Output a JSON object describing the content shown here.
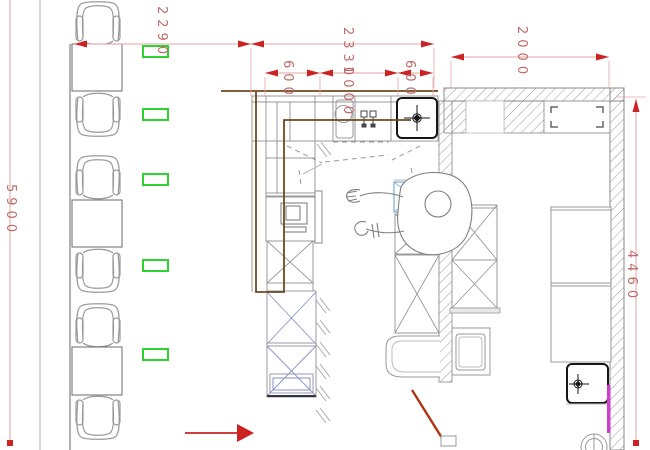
{
  "drawing": {
    "type": "floor-plan",
    "dimensions": {
      "seating_width": "2290",
      "kitchen_overall_width": "2330",
      "kitchen_center_segment": "1000",
      "kitchen_left_segment": "600",
      "kitchen_right_segment": "600",
      "right_room_width": "2000",
      "left_vertical_length": "5900",
      "right_vertical_length": "4460"
    },
    "colors": {
      "dimension_line": "#e3a6a6",
      "dimension_arrow": "#cc2222",
      "dimension_text": "#c06a6a",
      "cable_route": "#6b4a21",
      "marker_green": "#2fd32f",
      "cabinet_blue_x": "#8890cc",
      "cabinet_lightblue": "#85b5d6",
      "pipe_magenta": "#cc3fcc",
      "door_swing_red": "#b23310",
      "line_gray": "#999999"
    },
    "symbols": [
      "dining-chair",
      "dining-table",
      "socket-marker",
      "sink",
      "faucet",
      "cooktop-crosshair",
      "microwave",
      "person-top-view",
      "x-cabinet",
      "hatched-wall",
      "window",
      "floor-drain",
      "door-swing",
      "direction-arrow"
    ],
    "counts": {
      "dining_sets": 3,
      "chairs": 6,
      "tables": 3,
      "green_markers": 5
    }
  }
}
